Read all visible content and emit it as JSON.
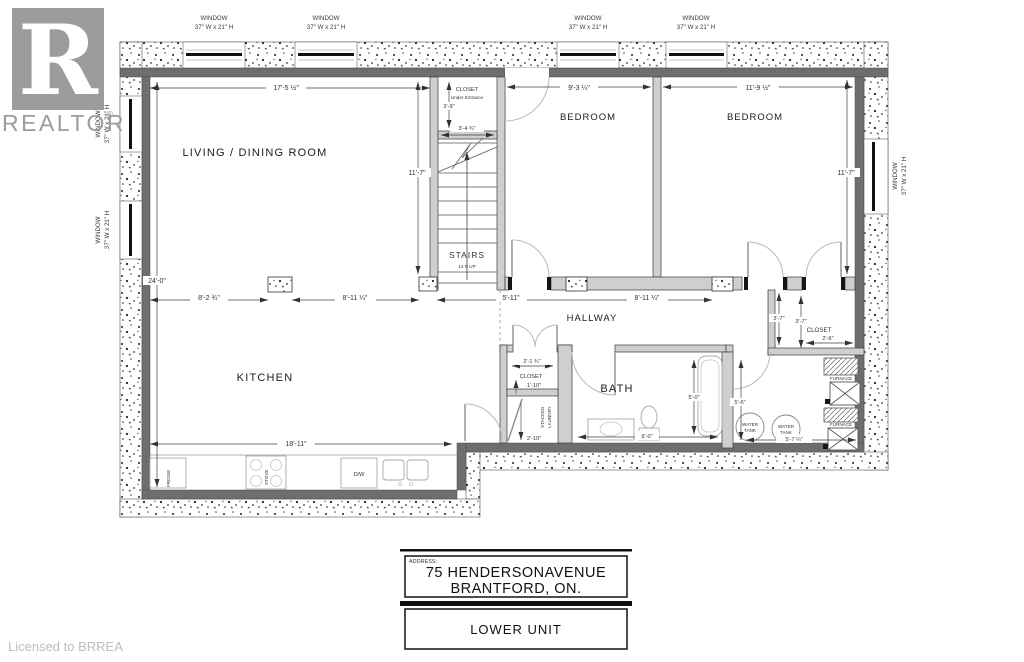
{
  "branding": {
    "logo_letter": "R",
    "realtor_text": "REALTOR",
    "registered": "®",
    "license": "Licensed to BRREA",
    "logo_color": "#9C9C9C"
  },
  "title_block": {
    "address_label": "ADDRESS:",
    "address_line1": "75 HENDERSONAVENUE",
    "address_line2": "BRANTFORD, ON.",
    "unit": "LOWER UNIT"
  },
  "window_label": {
    "line1": "WINDOW",
    "line2": "37\" W x 21\" H"
  },
  "rooms": {
    "living": "LIVING /  DINING ROOM",
    "kitchen": "KITCHEN",
    "bedroom1": "BEDROOM",
    "bedroom2": "BEDROOM",
    "hallway": "HALLWAY",
    "bath": "BATH",
    "stairs": "STAIRS",
    "stairs_riser": "13 R UP",
    "entry_closet_line1": "CLOSET",
    "entry_closet_line2": "Under Entrance",
    "hall_closet": "CLOSET",
    "bedroom_closet": "CLOSET"
  },
  "fixtures": {
    "fridge": "FRIDGE",
    "stove": "STOVE",
    "dishwasher": "D/W",
    "laundry_line1": "STACKED",
    "laundry_line2": "LAUNDRY",
    "water": "WATER",
    "tank": "TANK",
    "furnace": "FURNACE"
  },
  "dims": {
    "living_w": "17'-5 ½\"",
    "living_h": "11'-7\"",
    "overall_h": "24'-0\"",
    "entry_closet_h": "3'-9\"",
    "entry_closet_w": "3'-4 ¾\"",
    "bed1_w": "9'-3 ¼\"",
    "bed2_w": "11'-9 ½\"",
    "bed2_h": "11'-7\"",
    "kitchen_seg1": "8'-2 ¾\"",
    "kitchen_seg2": "8'-11 ¼\"",
    "hall_seg1": "5'-11\"",
    "hall_seg2": "8'-11 ¼\"",
    "counter": "18'-11\"",
    "hall_closet_w": "2'-1 ¾\"",
    "hall_closet_d": "1'-10\"",
    "laundry_d": "2'-10\"",
    "bath_h": "5'-0\"",
    "bath_w": "9'-0\"",
    "bed_closet_h1": "3'-7\"",
    "bed_closet_h2": "3'-7\"",
    "bed_closet_w": "2'-6\"",
    "utility_h": "5'-6\"",
    "utility_w": "5'-7 ¼\""
  }
}
